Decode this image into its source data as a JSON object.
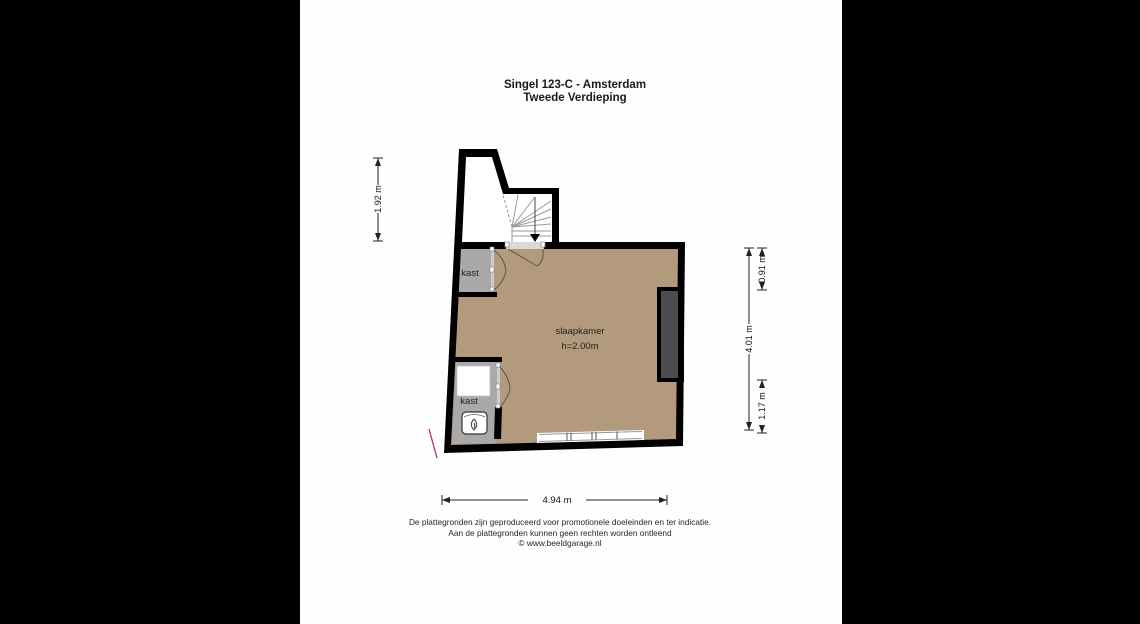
{
  "window": {
    "background": "#000000",
    "page_background": "#fefefe"
  },
  "title": {
    "line1": "Singel 123-C - Amsterdam",
    "line2": "Tweede Verdieping"
  },
  "floorplan": {
    "rooms": {
      "bedroom": {
        "label": "slaapkamer",
        "ceiling_height": "h=2.00m"
      },
      "closet_upper": {
        "label": "kast"
      },
      "closet_lower": {
        "label": "kast"
      }
    },
    "dimensions": {
      "left_height": "1.92 m",
      "right_total_height": "4.01 m",
      "right_upper": "0.91 m",
      "right_lower": "1.17 m",
      "bottom_width": "4.94 m"
    },
    "colors": {
      "walls": "#000000",
      "bedroom_floor": "#b49a7c",
      "closet_floor": "#a9a9a9",
      "chimney_breast": "#4d4d4d",
      "threshold": "#d9d9d9",
      "red_marker": "#bf3434"
    },
    "icons": {
      "stairs_down_arrow": "▼",
      "water_heater_flame": "flame"
    }
  },
  "footer": {
    "line1": "De plattegronden zijn geproduceerd voor promotionele doeleinden en ter indicatie.",
    "line2": "Aan de plattegronden kunnen geen rechten worden ontleend",
    "line3": "© www.beeldgarage.nl"
  }
}
